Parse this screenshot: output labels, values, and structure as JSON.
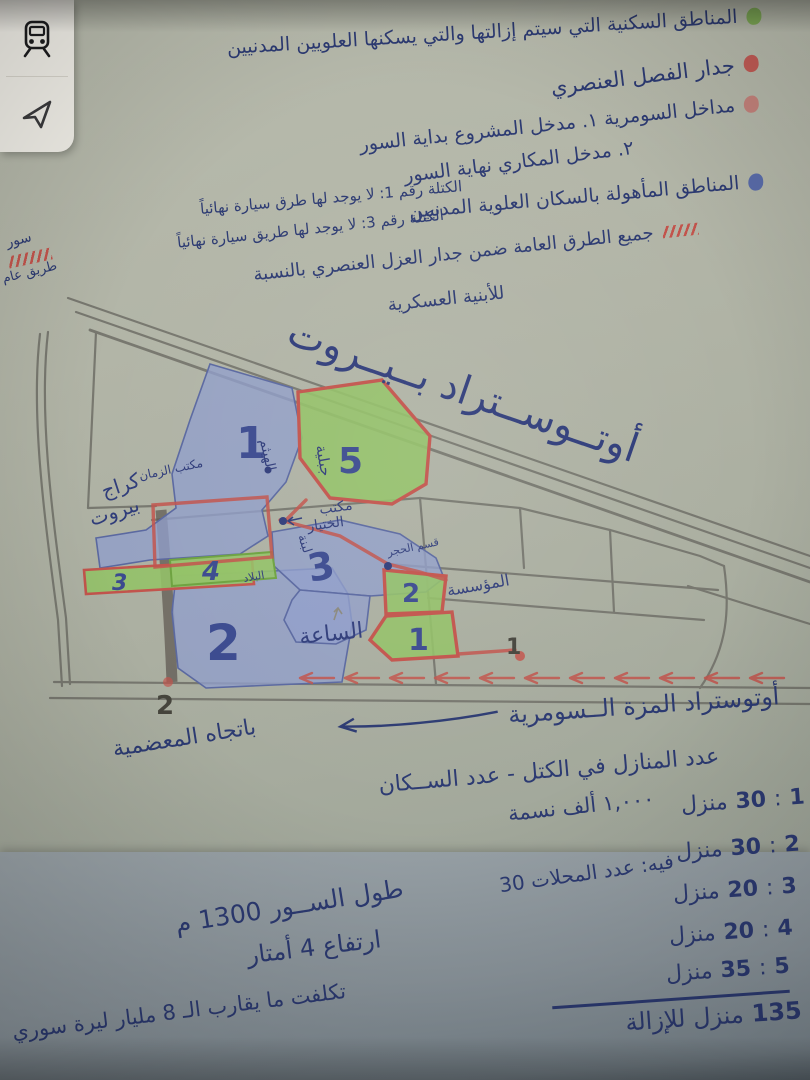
{
  "controls": {
    "transit_icon": "train-icon",
    "locate_icon": "navigation-arrow-icon"
  },
  "legend": {
    "items": [
      {
        "dot_color": "#79a94d",
        "text": "المناطق السكنية التي سيتم إزالتها والتي يسكنها العلويين المدنيين"
      },
      {
        "dot_color": "#c0504a",
        "text": "جدار الفصل العنصري"
      },
      {
        "dot_color": "#c37b74",
        "text": "مداخل السومرية ١. مدخل المشروع بداية السور",
        "text2": "٢. مدخل المكاري نهاية السور"
      },
      {
        "dot_color": "#4f63a8",
        "text": "المناطق المأهولة بالسكان العلوية المدنيين"
      }
    ],
    "block_note_1": "الكتلة رقم 1: لا يوجد لها طرق سيارة نهائياً",
    "block_note_2": "الكتلة رقم 3: لا يوجد لها طريق سيارة نهائياً",
    "wall_key": "سور",
    "road_key": "طريق عام",
    "roads_note_1": "جميع الطرق العامة ضمن جدار العزل العنصري بالنسبة",
    "roads_note_2": "للأبنية العسكرية"
  },
  "map": {
    "highway_label": "أوتــوســتراد  بــيــروت",
    "blue_region_1": "1",
    "blue_region_2": "2",
    "blue_region_3": "3",
    "green_region_5": "5",
    "green_region_4": "4",
    "green_region_3": "3",
    "green_region_2": "2",
    "green_region_1": "1",
    "wall_marker_1": "1",
    "wall_marker_2": "2",
    "labels": {
      "garage_line1": "كراج",
      "garage_line2": "بيروت",
      "zaman_office": "مكتب الزمان",
      "khtyar_office_line1": "مكتب",
      "khtyar_office_line2": "الختيار",
      "haytham": "الهيثم",
      "jabaliya": "جبلية",
      "labneh": "لبنة",
      "bilad": "البلاد",
      "clock": "الساعة",
      "institution": "المؤسسة",
      "stone_section": "قسم الحجر"
    },
    "colors": {
      "blue_fill": "#8f9dcb",
      "green_fill": "#93c167",
      "wall_red": "#c2544c",
      "pencil": "#72726a",
      "ink": "#2c3a72"
    }
  },
  "bottom": {
    "road_label": "أوتوستراد المزة الــسومرية",
    "road_direction": "باتجاه المعضمية",
    "stats_title": "عدد المنازل في الكتل - عدد الســكان",
    "colon": ":",
    "house_unit": "منزل",
    "houses": [
      {
        "block": "1",
        "count": "30"
      },
      {
        "block": "2",
        "count": "30"
      },
      {
        "block": "3",
        "count": "20"
      },
      {
        "block": "4",
        "count": "20"
      },
      {
        "block": "5",
        "count": "35"
      }
    ],
    "population": "١,٠٠٠ ألف نسمة",
    "shops_note": "فيه: عدد المحلات 30",
    "total_count": "135",
    "total_text": "منزل للإزالة",
    "wall_length": "طول الســور 1300 م",
    "wall_height": "ارتفاع 4 أمتار",
    "cost": "تكلفت ما يقارب الـ 8 مليار ليرة سوري"
  }
}
